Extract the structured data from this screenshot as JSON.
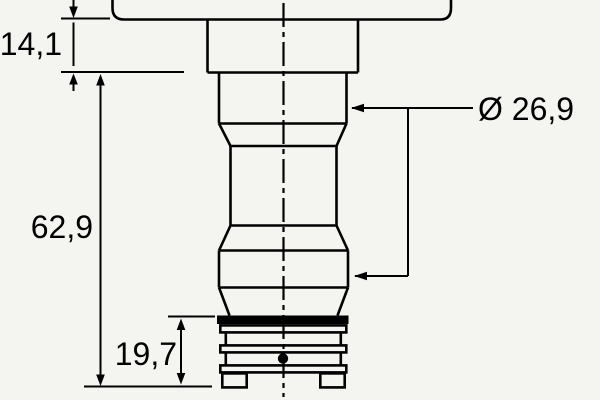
{
  "drawing": {
    "labels": {
      "top_section_height": "14,1",
      "body_height": "62,9",
      "lower_section_height": "19,7",
      "diameter": "Ø 26,9"
    },
    "colors": {
      "ink": "#000000",
      "paper": "#f4f4f1"
    }
  }
}
